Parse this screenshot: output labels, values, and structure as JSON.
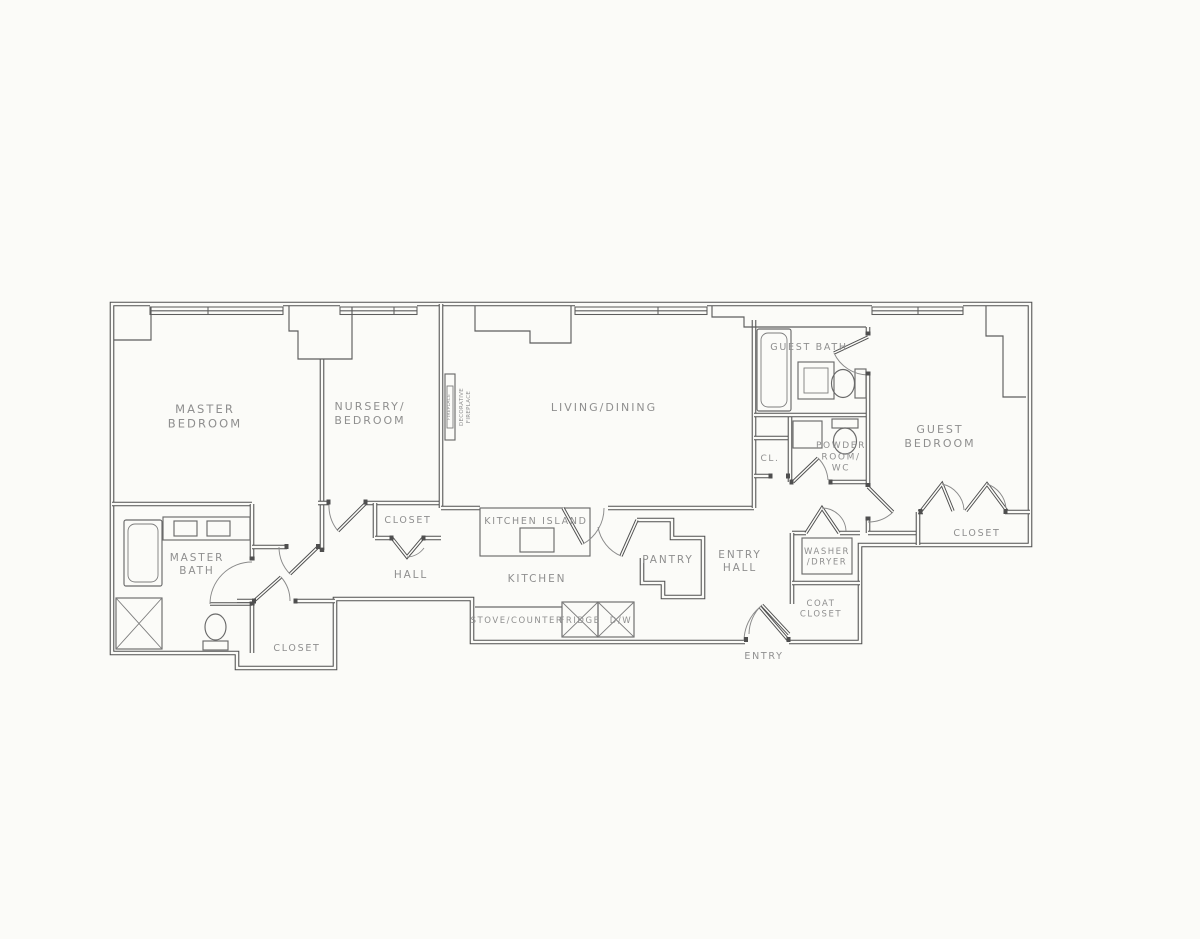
{
  "canvas": {
    "width": 1200,
    "height": 939,
    "background": "#fbfbf8",
    "wall_color": "#4f4f4f",
    "label_color": "#8f8f8f"
  },
  "floorplan": {
    "labels": [
      {
        "name": "master-bedroom",
        "lines": [
          "MASTER",
          "BEDROOM"
        ],
        "x": 205,
        "y": 413,
        "fs": 11.5
      },
      {
        "name": "nursery-bedroom",
        "lines": [
          "NURSERY/",
          "BEDROOM"
        ],
        "x": 370,
        "y": 410,
        "fs": 11
      },
      {
        "name": "living-dining",
        "lines": [
          "LIVING/DINING"
        ],
        "x": 604,
        "y": 411,
        "fs": 11
      },
      {
        "name": "guest-bath",
        "lines": [
          "GUEST BATH"
        ],
        "x": 809,
        "y": 350,
        "fs": 9.5
      },
      {
        "name": "hall-closet-cl",
        "lines": [
          "CL."
        ],
        "x": 770,
        "y": 461,
        "fs": 9
      },
      {
        "name": "powder-room-wc",
        "lines": [
          "POWDER",
          "ROOM/",
          "WC"
        ],
        "x": 841,
        "y": 448,
        "fs": 9
      },
      {
        "name": "guest-bedroom",
        "lines": [
          "GUEST",
          "BEDROOM"
        ],
        "x": 940,
        "y": 433,
        "fs": 11
      },
      {
        "name": "guest-bedroom-closet",
        "lines": [
          "CLOSET"
        ],
        "x": 977,
        "y": 536,
        "fs": 9.5
      },
      {
        "name": "nursery-closet",
        "lines": [
          "CLOSET"
        ],
        "x": 408,
        "y": 523,
        "fs": 9.5
      },
      {
        "name": "master-bath",
        "lines": [
          "MASTER",
          "BATH"
        ],
        "x": 197,
        "y": 561,
        "fs": 10.5
      },
      {
        "name": "master-closet",
        "lines": [
          "CLOSET"
        ],
        "x": 297,
        "y": 651,
        "fs": 9.5
      },
      {
        "name": "hall",
        "lines": [
          "HALL"
        ],
        "x": 411,
        "y": 578,
        "fs": 10.5
      },
      {
        "name": "kitchen-island",
        "lines": [
          "KITCHEN ISLAND"
        ],
        "x": 536,
        "y": 524,
        "fs": 9.5
      },
      {
        "name": "kitchen",
        "lines": [
          "KITCHEN"
        ],
        "x": 537,
        "y": 582,
        "fs": 10.5
      },
      {
        "name": "stove-counter",
        "lines": [
          "STOVE/COUNTER"
        ],
        "x": 517,
        "y": 623,
        "fs": 8.5
      },
      {
        "name": "fridge",
        "lines": [
          "FRIDGE"
        ],
        "x": 580,
        "y": 623,
        "fs": 8.5
      },
      {
        "name": "dishwasher",
        "lines": [
          "D/W"
        ],
        "x": 621,
        "y": 623,
        "fs": 8.5
      },
      {
        "name": "pantry",
        "lines": [
          "PANTRY"
        ],
        "x": 668,
        "y": 563,
        "fs": 10.5
      },
      {
        "name": "entry-hall",
        "lines": [
          "ENTRY",
          "HALL"
        ],
        "x": 740,
        "y": 558,
        "fs": 10.5
      },
      {
        "name": "washer-dryer",
        "lines": [
          "WASHER",
          "/DRYER"
        ],
        "x": 827,
        "y": 554,
        "fs": 8.5
      },
      {
        "name": "coat-closet",
        "lines": [
          "COAT",
          "CLOSET"
        ],
        "x": 821,
        "y": 606,
        "fs": 8.5
      },
      {
        "name": "entry",
        "lines": [
          "ENTRY"
        ],
        "x": 764,
        "y": 659,
        "fs": 9.5
      },
      {
        "name": "decorative-fireplace",
        "lines": [
          "DECORATIVE",
          "FIREPLACE"
        ],
        "x": 463,
        "y": 407,
        "fs": 5.5,
        "rot": -90,
        "ls": 0.3
      },
      {
        "name": "fireplace-inner",
        "lines": [
          "FIREPLACE"
        ],
        "x": 450,
        "y": 407,
        "fs": 4.5,
        "rot": -90,
        "ls": 0.2
      }
    ]
  }
}
